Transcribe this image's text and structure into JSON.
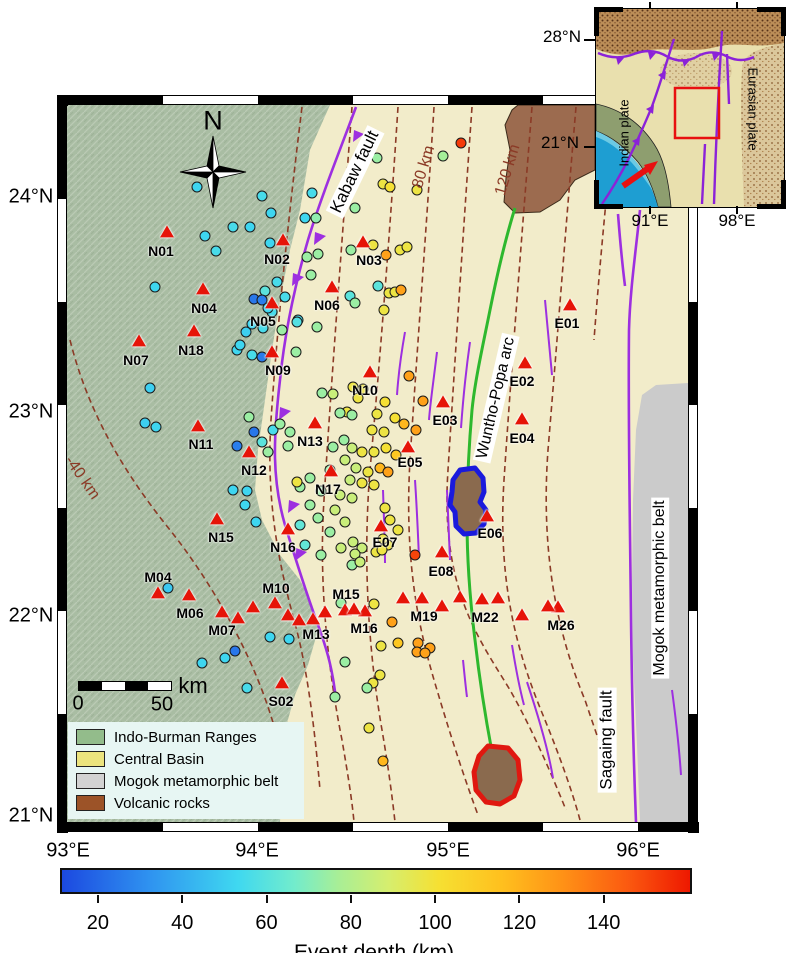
{
  "map": {
    "axis": {
      "lat": [
        {
          "label": "24°N",
          "y": 197
        },
        {
          "label": "23°N",
          "y": 412
        },
        {
          "label": "22°N",
          "y": 616
        },
        {
          "label": "21°N",
          "y": 816
        }
      ],
      "lon": [
        {
          "label": "93°E",
          "x": 68
        },
        {
          "label": "94°E",
          "x": 257
        },
        {
          "label": "95°E",
          "x": 448
        },
        {
          "label": "96°E",
          "x": 638
        }
      ]
    },
    "compass": {
      "label": "N"
    },
    "scalebar": {
      "zero": "0",
      "fifty": "50",
      "unit": "km"
    },
    "place_labels": [
      {
        "id": "kabaw-fault-label",
        "text": "Kabaw fault",
        "x": 355,
        "y": 172,
        "rot": -64,
        "size": 17,
        "bg": true,
        "color": "#000"
      },
      {
        "id": "wuntho-popa-arc-label",
        "text": "Wuntho-Popa arc",
        "x": 496,
        "y": 398,
        "rot": -77,
        "size": 16,
        "bg": true,
        "color": "#000"
      },
      {
        "id": "sagaing-fault-label",
        "text": "Sagaing fault",
        "x": 607,
        "y": 740,
        "rot": -90,
        "size": 17,
        "bg": true,
        "color": "#000"
      },
      {
        "id": "mogok-belt-label",
        "text": "Mogok metamorphic belt",
        "x": 660,
        "y": 588,
        "rot": -90,
        "size": 16,
        "bg": true,
        "color": "#000"
      },
      {
        "id": "contour-label-40",
        "text": "-40 km",
        "x": 82,
        "y": 478,
        "rot": 55,
        "size": 16,
        "bg": false,
        "color": "#8b3a26"
      },
      {
        "id": "contour-label-80",
        "text": "80 km",
        "x": 424,
        "y": 167,
        "rot": -73,
        "size": 16,
        "bg": false,
        "color": "#8b3a26"
      },
      {
        "id": "contour-label-120",
        "text": "120 km",
        "x": 508,
        "y": 170,
        "rot": -73,
        "size": 16,
        "bg": false,
        "color": "#8b3a26"
      }
    ],
    "stations": [
      {
        "id": "N01",
        "tx": 167,
        "ty": 232,
        "lx": 161,
        "ly": 251
      },
      {
        "id": "N02",
        "tx": 283,
        "ty": 240,
        "lx": 277,
        "ly": 259
      },
      {
        "id": "N03",
        "tx": 363,
        "ty": 242,
        "lx": 369,
        "ly": 260
      },
      {
        "id": "N04",
        "tx": 203,
        "ty": 289,
        "lx": 204,
        "ly": 308
      },
      {
        "id": "N05",
        "tx": 272,
        "ty": 303,
        "lx": 263,
        "ly": 321
      },
      {
        "id": "N06",
        "tx": 332,
        "ty": 287,
        "lx": 327,
        "ly": 305
      },
      {
        "id": "N07",
        "tx": 139,
        "ty": 341,
        "lx": 136,
        "ly": 360
      },
      {
        "id": "N18",
        "tx": 194,
        "ty": 331,
        "lx": 191,
        "ly": 350
      },
      {
        "id": "N09",
        "tx": 272,
        "ty": 352,
        "lx": 278,
        "ly": 370
      },
      {
        "id": "N10",
        "tx": 370,
        "ty": 372,
        "lx": 365,
        "ly": 390
      },
      {
        "id": "N11",
        "tx": 198,
        "ty": 426,
        "lx": 201,
        "ly": 444
      },
      {
        "id": "N12",
        "tx": 249,
        "ty": 452,
        "lx": 254,
        "ly": 470
      },
      {
        "id": "N13",
        "tx": 315,
        "ty": 423,
        "lx": 310,
        "ly": 441
      },
      {
        "id": "N15",
        "tx": 217,
        "ty": 519,
        "lx": 221,
        "ly": 537
      },
      {
        "id": "N16",
        "tx": 288,
        "ty": 529,
        "lx": 283,
        "ly": 547
      },
      {
        "id": "N17",
        "tx": 331,
        "ty": 471,
        "lx": 328,
        "ly": 489
      },
      {
        "id": "E01",
        "tx": 570,
        "ty": 305,
        "lx": 567,
        "ly": 323
      },
      {
        "id": "E02",
        "tx": 525,
        "ty": 363,
        "lx": 522,
        "ly": 381
      },
      {
        "id": "E03",
        "tx": 443,
        "ty": 402,
        "lx": 445,
        "ly": 420
      },
      {
        "id": "E04",
        "tx": 522,
        "ty": 419,
        "lx": 522,
        "ly": 438
      },
      {
        "id": "E05",
        "tx": 408,
        "ty": 447,
        "lx": 410,
        "ly": 462
      },
      {
        "id": "E06",
        "tx": 487,
        "ty": 516,
        "lx": 490,
        "ly": 533
      },
      {
        "id": "E07",
        "tx": 381,
        "ty": 526,
        "lx": 385,
        "ly": 542
      },
      {
        "id": "E08",
        "tx": 442,
        "ty": 552,
        "lx": 441,
        "ly": 571
      },
      {
        "id": "M04",
        "tx": 158,
        "ty": 593,
        "lx": 158,
        "ly": 577
      },
      {
        "id": "M06",
        "tx": 189,
        "ty": 595,
        "lx": 190,
        "ly": 613
      },
      {
        "id": "M07",
        "tx": 222,
        "ty": 612,
        "lx": 222,
        "ly": 630
      },
      {
        "id": "M10",
        "tx": 275,
        "ty": 603,
        "lx": 276,
        "ly": 588
      },
      {
        "id": "M13",
        "tx": 313,
        "ty": 619,
        "lx": 316,
        "ly": 634
      },
      {
        "id": "M15",
        "tx": 345,
        "ty": 610,
        "lx": 346,
        "ly": 594
      },
      {
        "id": "M16",
        "tx": 365,
        "ty": 611,
        "lx": 364,
        "ly": 628
      },
      {
        "id": "M19",
        "tx": 422,
        "ty": 598,
        "lx": 424,
        "ly": 616
      },
      {
        "id": "M22",
        "tx": 482,
        "ty": 599,
        "lx": 485,
        "ly": 617
      },
      {
        "id": "M26",
        "tx": 558,
        "ty": 607,
        "lx": 561,
        "ly": 625
      },
      {
        "id": "S02",
        "tx": 282,
        "ty": 683,
        "lx": 281,
        "ly": 701
      }
    ],
    "extra_triangles": [
      [
        238,
        618
      ],
      [
        253,
        607
      ],
      [
        288,
        615
      ],
      [
        299,
        620
      ],
      [
        325,
        612
      ],
      [
        354,
        609
      ],
      [
        403,
        598
      ],
      [
        442,
        606
      ],
      [
        460,
        597
      ],
      [
        498,
        598
      ],
      [
        522,
        615
      ],
      [
        548,
        606
      ]
    ],
    "events": [
      [
        197,
        187,
        52
      ],
      [
        262,
        196,
        55
      ],
      [
        271,
        213,
        52
      ],
      [
        233,
        227,
        55
      ],
      [
        205,
        236,
        52
      ],
      [
        250,
        227,
        52
      ],
      [
        270,
        243,
        52
      ],
      [
        216,
        251,
        55
      ],
      [
        155,
        287,
        52
      ],
      [
        277,
        282,
        55
      ],
      [
        265,
        291,
        60
      ],
      [
        285,
        297,
        55
      ],
      [
        272,
        312,
        55
      ],
      [
        298,
        320,
        55
      ],
      [
        316,
        218,
        72
      ],
      [
        254,
        299,
        24
      ],
      [
        262,
        300,
        26
      ],
      [
        262,
        357,
        25
      ],
      [
        254,
        432,
        24
      ],
      [
        237,
        446,
        26
      ],
      [
        235,
        651,
        24
      ],
      [
        252,
        324,
        52
      ],
      [
        263,
        328,
        55
      ],
      [
        246,
        332,
        50
      ],
      [
        237,
        350,
        52
      ],
      [
        252,
        355,
        55
      ],
      [
        240,
        345,
        52
      ],
      [
        268,
        308,
        52
      ],
      [
        297,
        322,
        58
      ],
      [
        317,
        327,
        74
      ],
      [
        296,
        352,
        74
      ],
      [
        282,
        330,
        74
      ],
      [
        307,
        257,
        74
      ],
      [
        311,
        275,
        74
      ],
      [
        318,
        254,
        74
      ],
      [
        355,
        208,
        74
      ],
      [
        351,
        250,
        74
      ],
      [
        377,
        158,
        74
      ],
      [
        443,
        156,
        76
      ],
      [
        350,
        296,
        60
      ],
      [
        355,
        303,
        74
      ],
      [
        378,
        286,
        60
      ],
      [
        312,
        193,
        55
      ],
      [
        305,
        218,
        52
      ],
      [
        373,
        245,
        97
      ],
      [
        383,
        184,
        97
      ],
      [
        390,
        187,
        100
      ],
      [
        417,
        190,
        97
      ],
      [
        400,
        250,
        97
      ],
      [
        407,
        247,
        97
      ],
      [
        389,
        293,
        97
      ],
      [
        395,
        292,
        97
      ],
      [
        384,
        310,
        97
      ],
      [
        386,
        255,
        125
      ],
      [
        401,
        290,
        125
      ],
      [
        461,
        143,
        152
      ],
      [
        322,
        393,
        74
      ],
      [
        333,
        394,
        85
      ],
      [
        353,
        387,
        97
      ],
      [
        363,
        389,
        97
      ],
      [
        347,
        412,
        97
      ],
      [
        340,
        413,
        74
      ],
      [
        352,
        415,
        74
      ],
      [
        358,
        398,
        97
      ],
      [
        385,
        402,
        100
      ],
      [
        409,
        376,
        125
      ],
      [
        423,
        401,
        125
      ],
      [
        377,
        414,
        97
      ],
      [
        395,
        418,
        100
      ],
      [
        404,
        424,
        118
      ],
      [
        416,
        430,
        125
      ],
      [
        372,
        430,
        97
      ],
      [
        384,
        432,
        97
      ],
      [
        344,
        440,
        74
      ],
      [
        333,
        447,
        74
      ],
      [
        352,
        448,
        85
      ],
      [
        362,
        452,
        97
      ],
      [
        374,
        452,
        97
      ],
      [
        386,
        448,
        100
      ],
      [
        396,
        455,
        112
      ],
      [
        345,
        460,
        85
      ],
      [
        330,
        470,
        74
      ],
      [
        356,
        468,
        85
      ],
      [
        368,
        472,
        97
      ],
      [
        380,
        468,
        118
      ],
      [
        388,
        472,
        125
      ],
      [
        350,
        480,
        85
      ],
      [
        362,
        483,
        97
      ],
      [
        374,
        485,
        97
      ],
      [
        310,
        478,
        74
      ],
      [
        300,
        487,
        74
      ],
      [
        321,
        491,
        74
      ],
      [
        340,
        495,
        85
      ],
      [
        352,
        498,
        85
      ],
      [
        310,
        505,
        74
      ],
      [
        335,
        510,
        85
      ],
      [
        318,
        518,
        74
      ],
      [
        300,
        525,
        62
      ],
      [
        345,
        522,
        85
      ],
      [
        330,
        532,
        74
      ],
      [
        305,
        545,
        62
      ],
      [
        341,
        548,
        85
      ],
      [
        321,
        555,
        74
      ],
      [
        385,
        508,
        97
      ],
      [
        390,
        520,
        97
      ],
      [
        398,
        530,
        97
      ],
      [
        388,
        545,
        97
      ],
      [
        376,
        552,
        97
      ],
      [
        352,
        565,
        74
      ],
      [
        383,
        539,
        97
      ],
      [
        362,
        548,
        85
      ],
      [
        355,
        554,
        85
      ],
      [
        360,
        562,
        85
      ],
      [
        382,
        550,
        97
      ],
      [
        353,
        542,
        85
      ],
      [
        297,
        482,
        97
      ],
      [
        249,
        417,
        74
      ],
      [
        273,
        430,
        55
      ],
      [
        280,
        424,
        74
      ],
      [
        290,
        432,
        74
      ],
      [
        262,
        442,
        60
      ],
      [
        288,
        446,
        74
      ],
      [
        268,
        452,
        74
      ],
      [
        233,
        490,
        52
      ],
      [
        247,
        491,
        52
      ],
      [
        245,
        505,
        52
      ],
      [
        256,
        522,
        52
      ],
      [
        150,
        388,
        50
      ],
      [
        145,
        423,
        50
      ],
      [
        156,
        427,
        52
      ],
      [
        168,
        588,
        48
      ],
      [
        202,
        663,
        52
      ],
      [
        270,
        637,
        52
      ],
      [
        289,
        639,
        52
      ],
      [
        225,
        658,
        52
      ],
      [
        247,
        688,
        55
      ],
      [
        341,
        603,
        74
      ],
      [
        374,
        604,
        97
      ],
      [
        392,
        622,
        125
      ],
      [
        381,
        646,
        97
      ],
      [
        398,
        643,
        112
      ],
      [
        418,
        643,
        125
      ],
      [
        430,
        648,
        125
      ],
      [
        417,
        652,
        125
      ],
      [
        425,
        653,
        125
      ],
      [
        345,
        662,
        74
      ],
      [
        380,
        675,
        97
      ],
      [
        373,
        683,
        97
      ],
      [
        367,
        688,
        74
      ],
      [
        369,
        728,
        97
      ],
      [
        335,
        697,
        74
      ],
      [
        383,
        761,
        118
      ],
      [
        415,
        555,
        150
      ]
    ],
    "legend": {
      "items": [
        {
          "label": "Indo-Burman Ranges",
          "color": "#93bc8b"
        },
        {
          "label": "Central Basin",
          "color": "#ece47e"
        },
        {
          "label": "Mogok metamorphic belt",
          "color": "#d2d2d2"
        },
        {
          "label": "Volcanic rocks",
          "color": "#9c5328"
        }
      ]
    }
  },
  "inset": {
    "lat_top": "28°N",
    "lat_bottom": "21°N",
    "lon_left": "91°E",
    "lon_right": "98°E",
    "plate_west": "Indian plate",
    "plate_east": "Eurasian plate"
  },
  "colorbar": {
    "title": "Event depth (km)",
    "ticks": [
      20,
      40,
      60,
      80,
      100,
      120,
      140
    ],
    "domain": [
      11,
      160
    ],
    "stops": [
      [
        0,
        "#1c49e0"
      ],
      [
        0.14,
        "#2f93f0"
      ],
      [
        0.28,
        "#3fd8f0"
      ],
      [
        0.37,
        "#72eccc"
      ],
      [
        0.44,
        "#a8ee96"
      ],
      [
        0.52,
        "#d6ee6e"
      ],
      [
        0.6,
        "#f6e032"
      ],
      [
        0.7,
        "#ffc01e"
      ],
      [
        0.8,
        "#ff9016"
      ],
      [
        0.9,
        "#fb5a10"
      ],
      [
        1,
        "#ee1800"
      ]
    ]
  }
}
